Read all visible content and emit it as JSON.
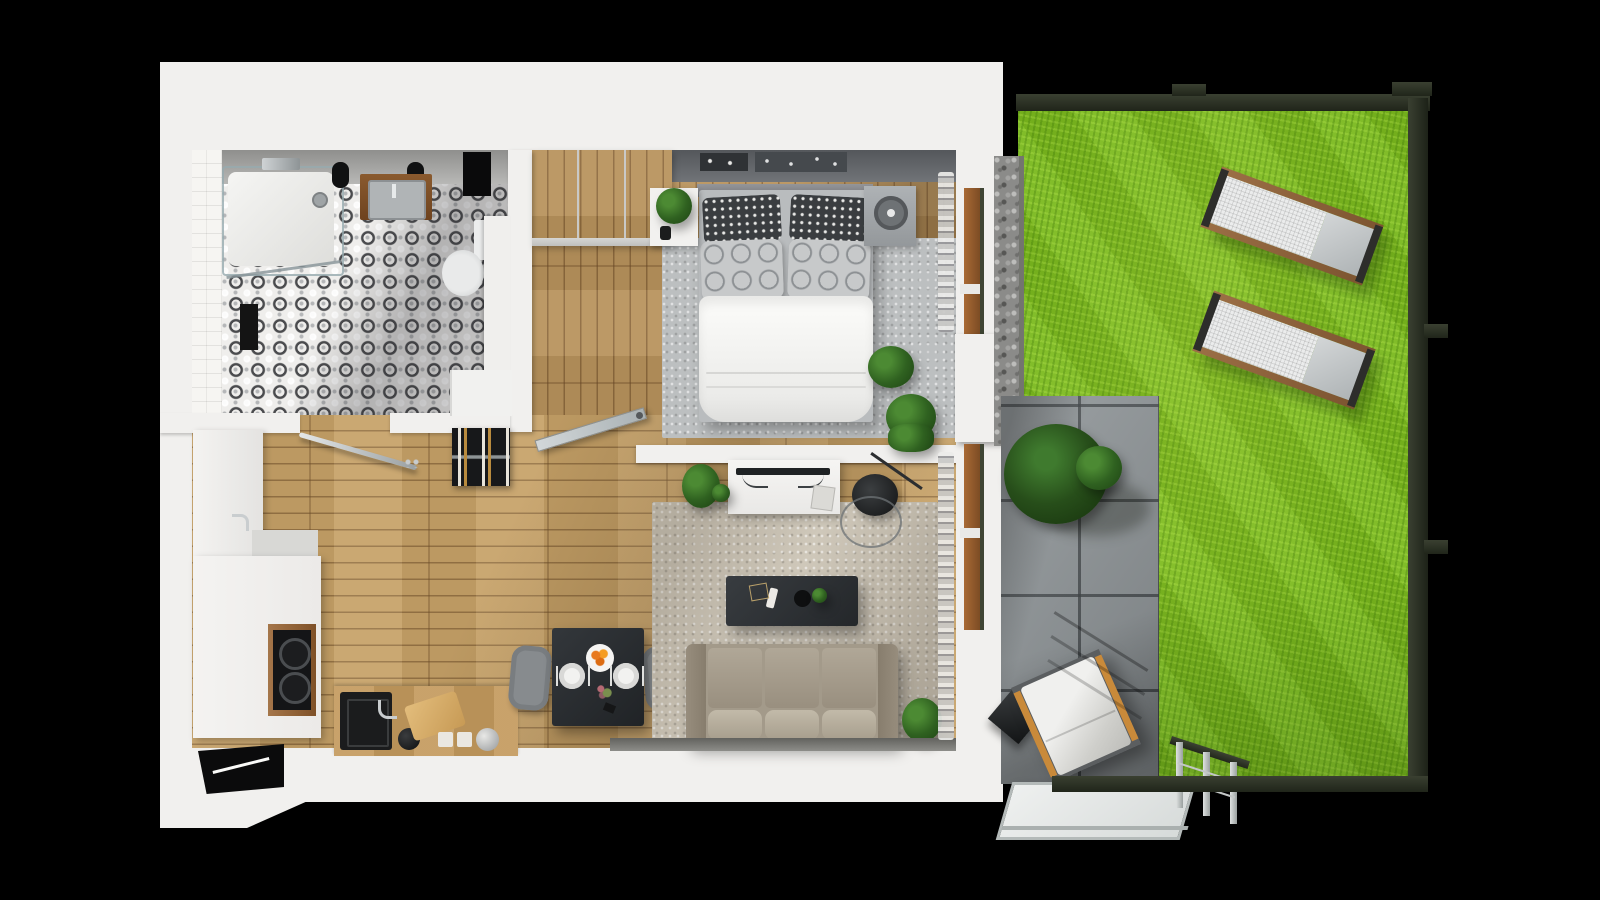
{
  "image": {
    "kind": "3d-floor-plan-render-top-view",
    "description": "Photorealistic top-down 3D render of a one-bedroom apartment with terrace and fenced garden on black background",
    "visible_text": []
  },
  "colors": {
    "bg": "#000000",
    "wall": "#f1f0ee",
    "wallFace": "#9a9a98",
    "wood": "#c6a167",
    "woodBedroom": "#b8935c",
    "grass": "#7ab91e",
    "fence": "#262b1e",
    "paver": "#8f9598",
    "gravel": "#8b8b89",
    "sofa": "#a39a8a",
    "rugLiving": "#cfc8ba",
    "rugBedroom": "#bcbfc0",
    "tableDark": "#2e3236",
    "frameBrown": "#8a5a30",
    "orange": "#e8791f"
  },
  "rooms": {
    "bathroom": {
      "floor": "black-white-ornament-tile",
      "items": [
        "shower-tray",
        "shower-glass",
        "wall-mixer",
        "black-sconce-left",
        "black-sconce-right",
        "wall-niche",
        "vanity-sink",
        "toilet",
        "side-cabinet",
        "washing-machine",
        "bath-mat"
      ]
    },
    "bedroom": {
      "floor": "wood-planks",
      "items": [
        "wardrobe",
        "top-shelf-decor",
        "headboard",
        "double-bed",
        "dot-pillow-left",
        "dot-pillow-right",
        "circle-pillow-left",
        "circle-pillow-right",
        "duvet",
        "nightstand-left",
        "plant-on-nightstand",
        "nightstand-right",
        "table-fan",
        "rug",
        "plant-1",
        "plant-2",
        "curtain",
        "glass-door"
      ]
    },
    "hall-kitchen": {
      "floor": "wood-planks",
      "items": [
        "coat-rail",
        "wine-rack",
        "tall-cabinet",
        "built-in-ovens",
        "counter-top",
        "kitchen-sink",
        "black-kettle",
        "cutting-board",
        "hot-pads",
        "silver-kettle",
        "entry-niche"
      ]
    },
    "dining": {
      "items": [
        "dark-table",
        "chair-left",
        "chair-right",
        "plate-left",
        "plate-right",
        "orange-bowl",
        "flower-posy",
        "cutlery"
      ]
    },
    "living": {
      "items": [
        "tv-sideboard",
        "tv",
        "book",
        "plant-left",
        "plant-wall",
        "floor-lamp",
        "lamp-ring",
        "rug",
        "coffee-table",
        "remote",
        "gold-frame",
        "black-bowl",
        "mini-plant",
        "sofa",
        "curtain"
      ]
    }
  },
  "exterior": {
    "terrace": {
      "floor": "concrete-pavers",
      "items": [
        "potted-tree",
        "lounge-chair",
        "side-table",
        "glass-canopy",
        "railing"
      ]
    },
    "garden": {
      "floor": "lawn",
      "items": [
        "gravel-strip",
        "sun-lounger-top",
        "sun-lounger-bottom",
        "fence-top",
        "fence-right",
        "fence-bottom",
        "fence-bracket-1",
        "fence-bracket-2",
        "fence-bracket-3",
        "fence-bracket-4"
      ]
    }
  }
}
